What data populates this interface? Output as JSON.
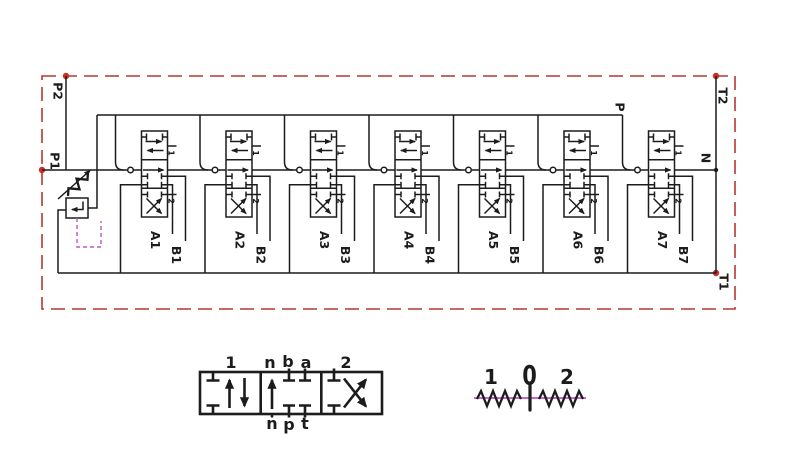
{
  "ports": {
    "p2": "P2",
    "p1": "P1",
    "p": "P",
    "t2": "T2",
    "n": "N",
    "t1": "T1"
  },
  "sections": [
    {
      "a": "A1",
      "b": "B1",
      "pos1": "1",
      "pos2": "2"
    },
    {
      "a": "A2",
      "b": "B2",
      "pos1": "1",
      "pos2": "2"
    },
    {
      "a": "A3",
      "b": "B3",
      "pos1": "1",
      "pos2": "2"
    },
    {
      "a": "A4",
      "b": "B4",
      "pos1": "1",
      "pos2": "2"
    },
    {
      "a": "A5",
      "b": "B5",
      "pos1": "1",
      "pos2": "2"
    },
    {
      "a": "A6",
      "b": "B6",
      "pos1": "1",
      "pos2": "2"
    },
    {
      "a": "A7",
      "b": "B7",
      "pos1": "1",
      "pos2": "2"
    }
  ],
  "detail_valve": {
    "label_1": "1",
    "label_2": "2",
    "top_n": "n",
    "top_b": "b",
    "top_a": "a",
    "bottom_n": "n",
    "bottom_p": "p",
    "bottom_t": "t"
  },
  "detail_lever": {
    "left": "1",
    "center": "0",
    "right": "2"
  },
  "colors": {
    "line": "#1c1c1c",
    "boundary_red": "#b23a31",
    "port_dot_red": "#cf2e24",
    "pilot_magenta": "#c353c3"
  }
}
